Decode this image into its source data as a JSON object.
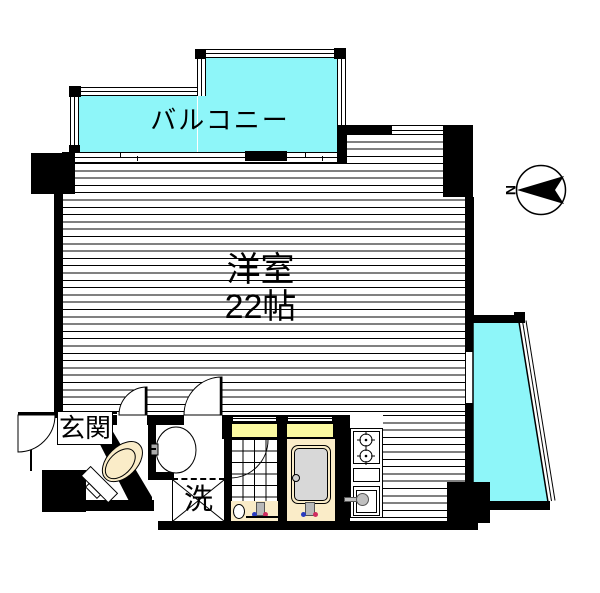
{
  "labels": {
    "balcony_top": "バルコニー",
    "balcony_right": "バルコニー",
    "room_name": "洋室",
    "room_size": "22帖",
    "entrance": "玄関",
    "laundry": "洗",
    "compass": "N"
  },
  "colors": {
    "balcony_cyan": "#8ef6f9",
    "window_yellow": "#fbf9a0",
    "fixture_cream": "#faecc8",
    "tub_gray": "#d8d8d8",
    "wall_black": "#000000"
  }
}
